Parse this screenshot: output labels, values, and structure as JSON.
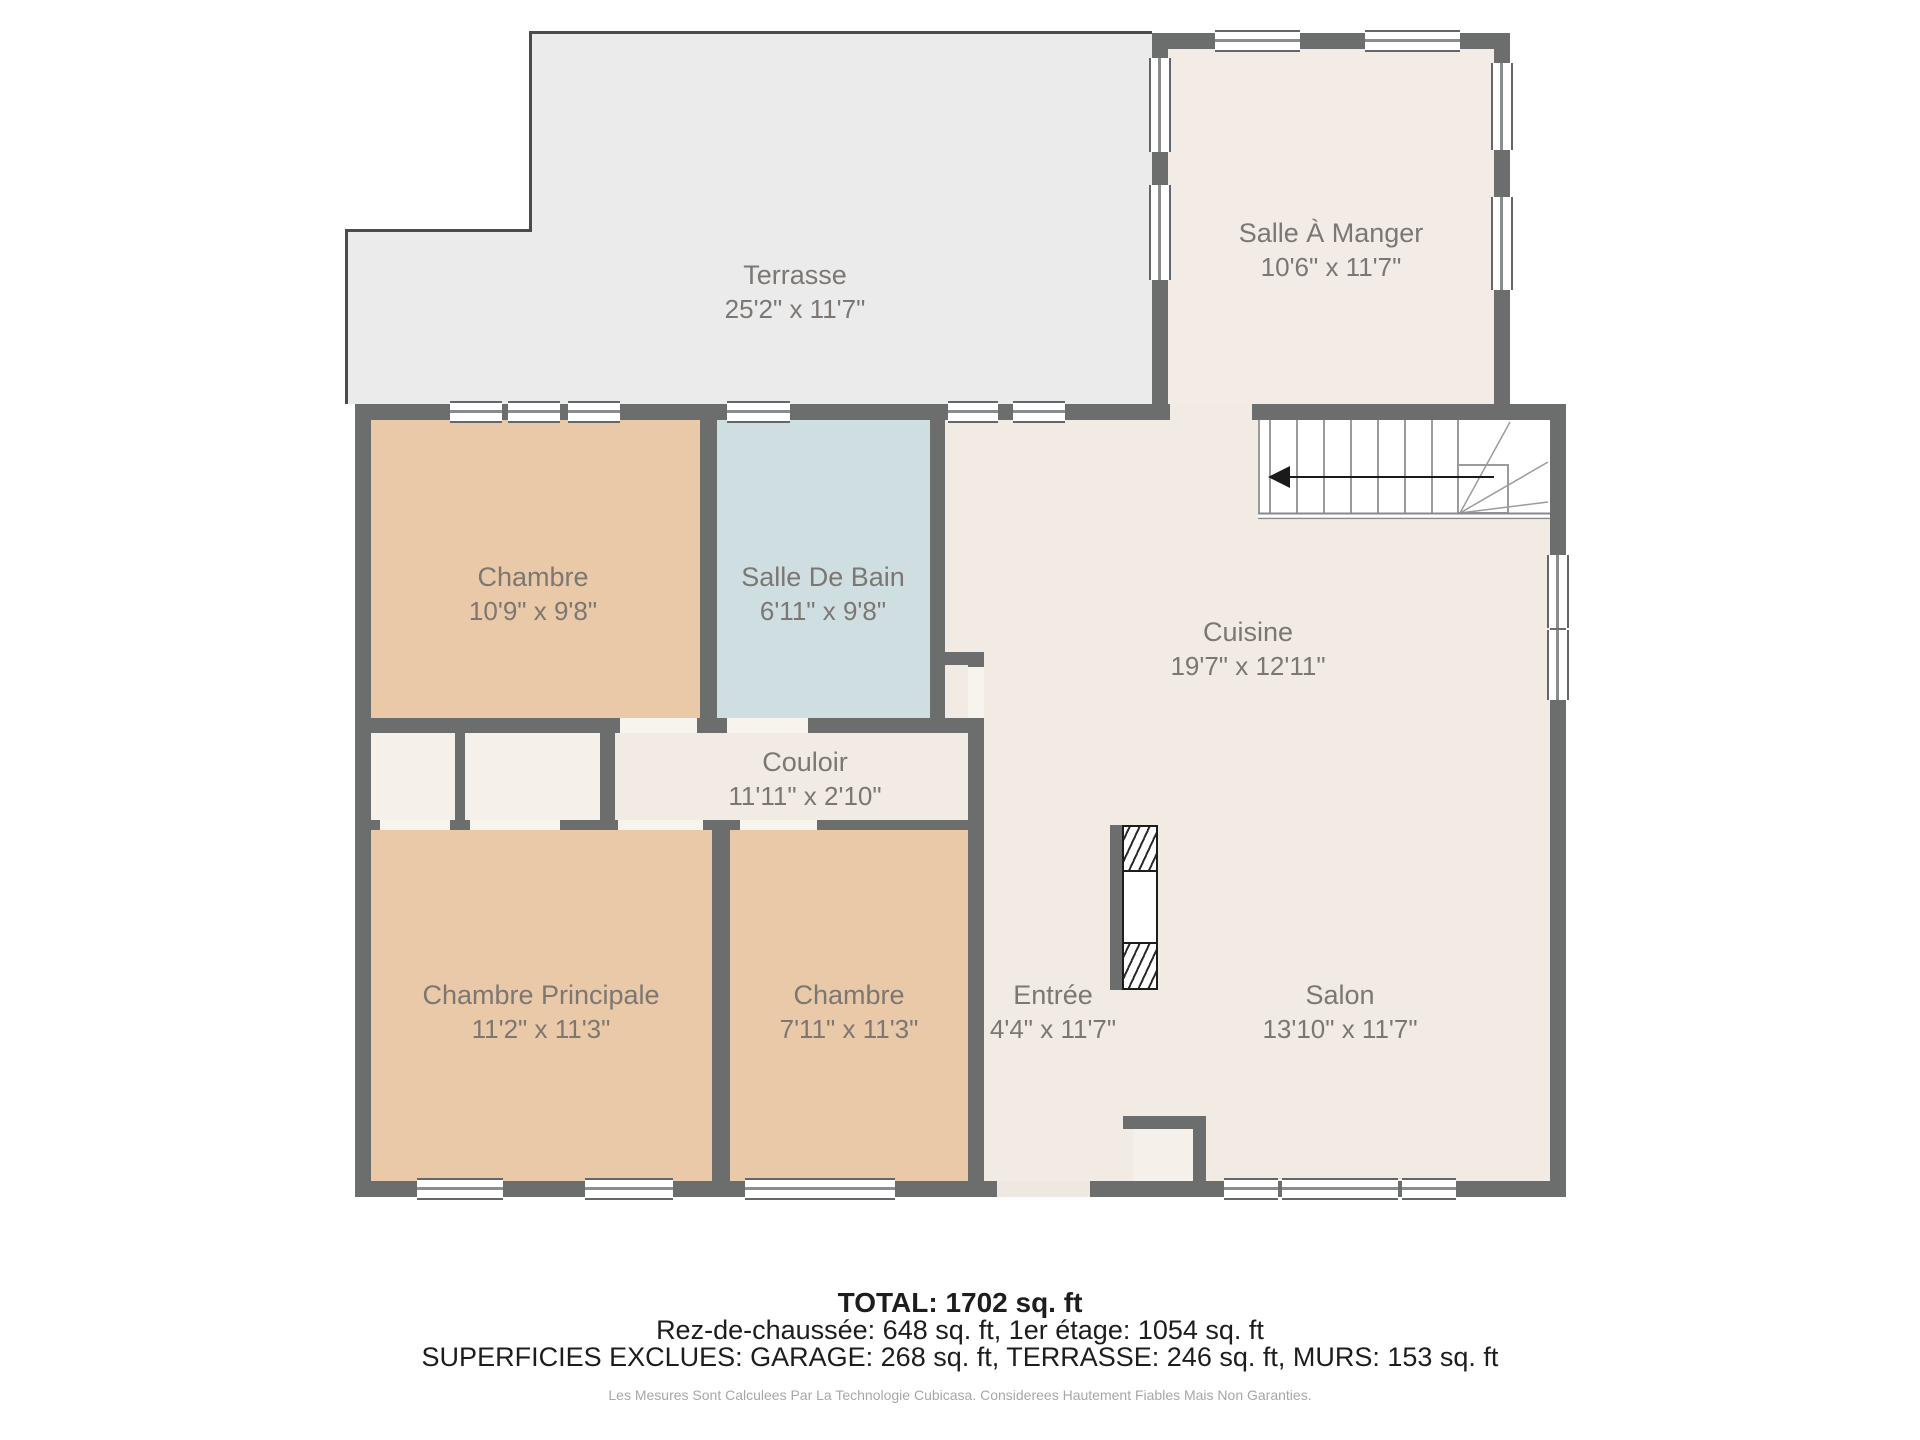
{
  "rooms": {
    "terrasse": {
      "name": "Terrasse",
      "dims": "25'2\" x 11'7\""
    },
    "salle_a_manger": {
      "name": "Salle À Manger",
      "dims": "10'6\" x 11'7\""
    },
    "chambre_haut": {
      "name": "Chambre",
      "dims": "10'9\" x 9'8\""
    },
    "salle_de_bain": {
      "name": "Salle De Bain",
      "dims": "6'11\" x 9'8\""
    },
    "cuisine": {
      "name": "Cuisine",
      "dims": "19'7\" x 12'11\""
    },
    "couloir": {
      "name": "Couloir",
      "dims": "11'11\" x 2'10\""
    },
    "chambre_principale": {
      "name": "Chambre Principale",
      "dims": "11'2\" x 11'3\""
    },
    "chambre_bas": {
      "name": "Chambre",
      "dims": "7'11\" x 11'3\""
    },
    "entree": {
      "name": "Entrée",
      "dims": "4'4\" x 11'7\""
    },
    "salon": {
      "name": "Salon",
      "dims": "13'10\" x 11'7\""
    }
  },
  "summary": {
    "total": "TOTAL: 1702 sq. ft",
    "floors": "Rez-de-chaussée: 648 sq. ft, 1er étage: 1054 sq. ft",
    "excluded": "SUPERFICIES EXCLUES: GARAGE: 268 sq. ft, TERRASSE: 246 sq. ft, MURS: 153 sq. ft",
    "disclaimer": "Les Mesures Sont Calculees Par La Technologie Cubicasa. Considerees Hautement Fiables Mais Non Garanties."
  },
  "colors": {
    "wall": "#6c6e6e",
    "floor_common": "#f2ebe4",
    "floor_bedroom": "#e9c9a8",
    "floor_bathroom": "#cfdfe1",
    "floor_terrace": "#ebebeb",
    "label_text": "#7c7772"
  }
}
